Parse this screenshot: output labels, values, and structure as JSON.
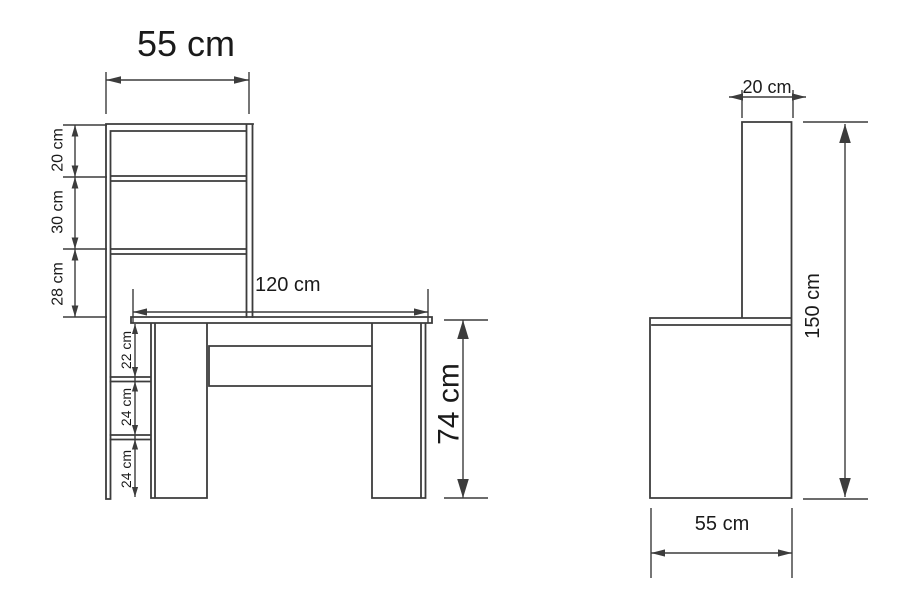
{
  "diagram": {
    "kind": "furniture dimension drawing (desk with bookshelf, front and side views)",
    "views": {
      "front": {
        "title": "55 cm",
        "labels": {
          "shelf_gap_1": "20 cm",
          "shelf_gap_2": "30 cm",
          "shelf_gap_3": "28 cm",
          "desk_width": "120 cm",
          "desk_height": "74 cm",
          "under_gap_1": "22 cm",
          "under_gap_2": "24 cm",
          "under_gap_3": "24 cm"
        }
      },
      "side": {
        "labels": {
          "column_depth": "20 cm",
          "total_height": "150 cm",
          "desk_depth": "55 cm"
        }
      }
    },
    "colors": {
      "line": "#3c3c3c",
      "text": "#1a1a1a",
      "background": "#ffffff"
    }
  }
}
